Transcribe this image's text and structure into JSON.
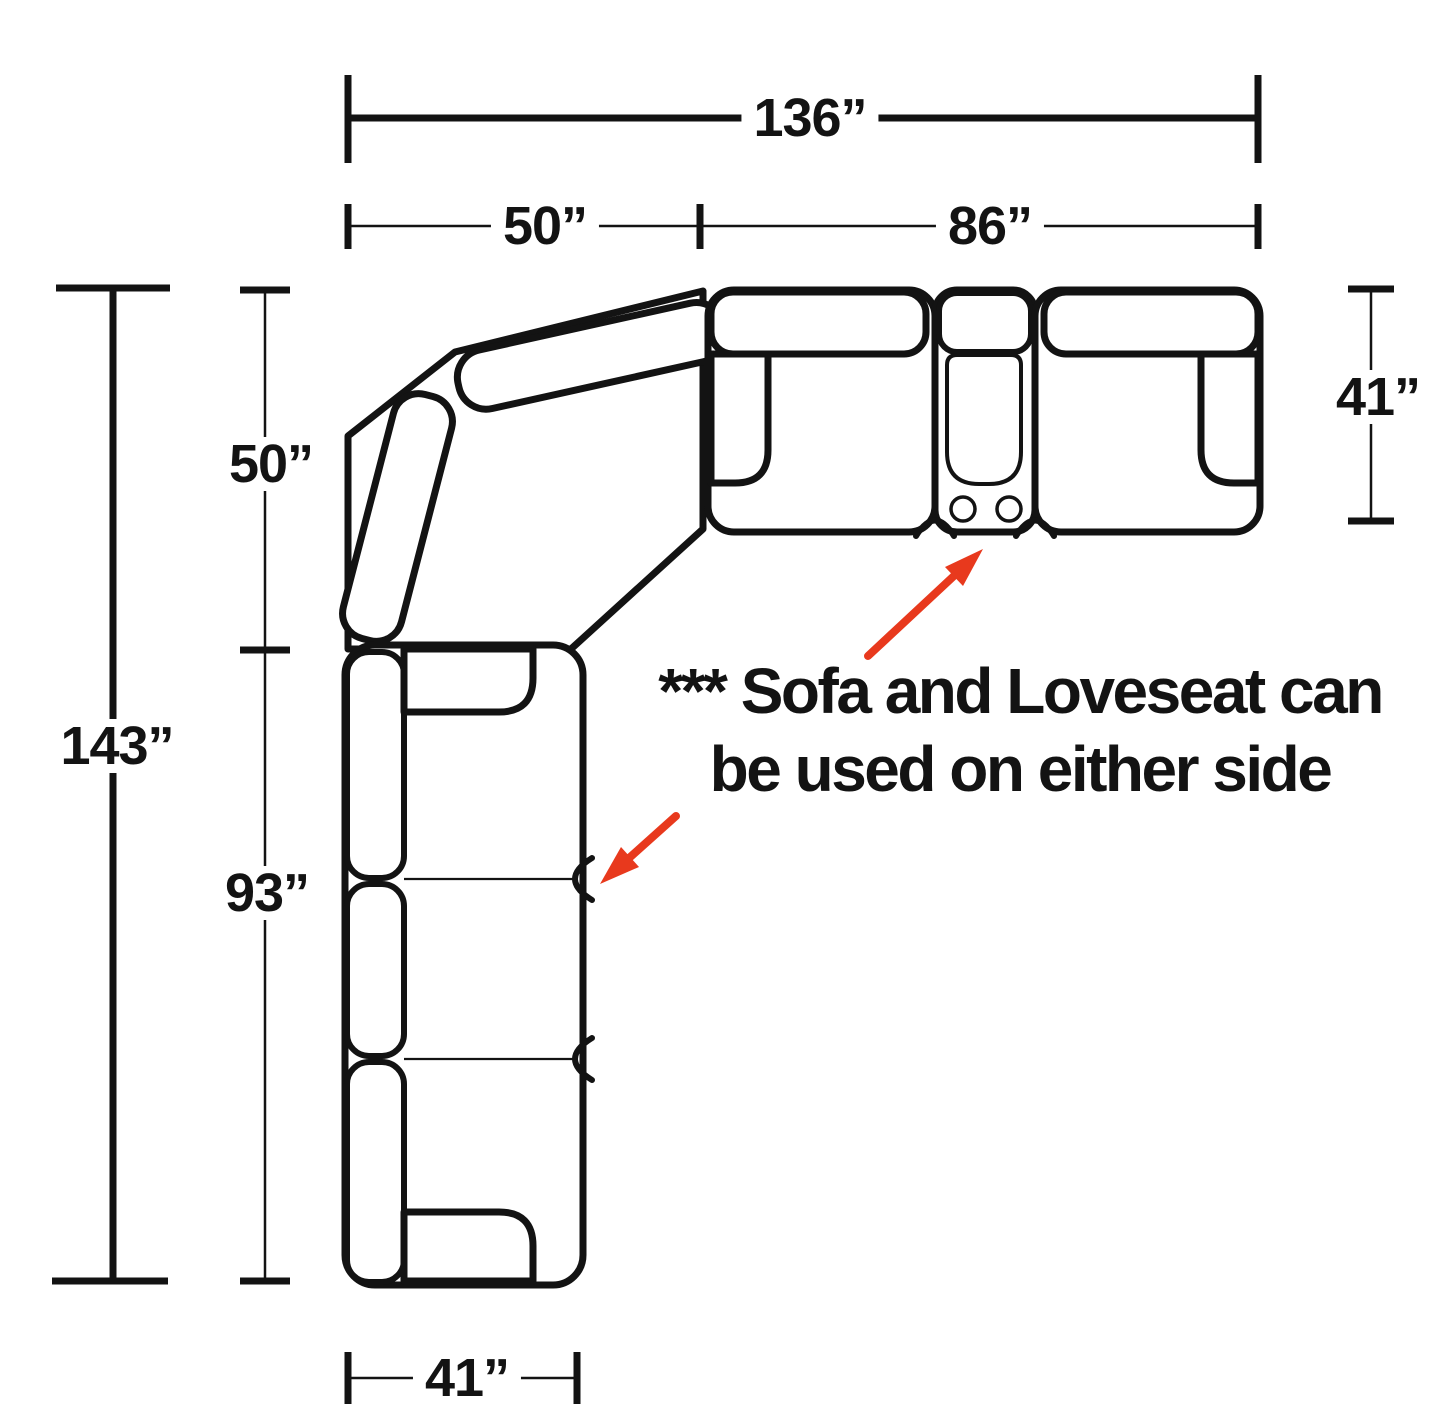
{
  "diagram": {
    "dimensions": {
      "total_width": "136”",
      "corner_width": "50”",
      "loveseat_width": "86”",
      "loveseat_depth": "41”",
      "corner_height": "50”",
      "total_height": "143”",
      "sofa_length": "93”",
      "sofa_width": "41”"
    },
    "note": {
      "line1": "*** Sofa and Loveseat can",
      "line2": "be used on either side"
    },
    "colors": {
      "line": "#131313",
      "arrow": "#e8391d",
      "background": "#ffffff"
    }
  }
}
